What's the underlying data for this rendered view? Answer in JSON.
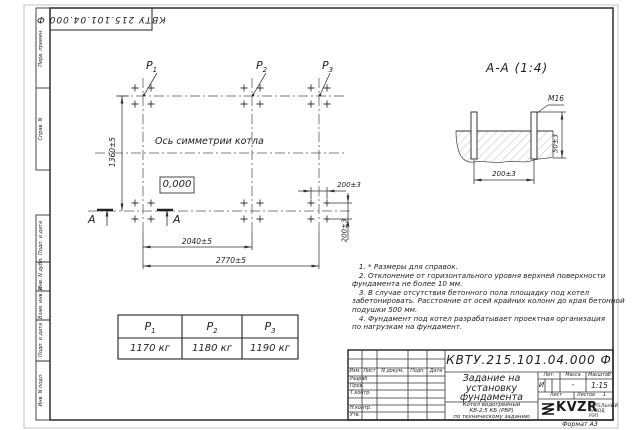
{
  "frame": {
    "stamp_code": "КВТУ 215.101.04.000 Ф",
    "top_margin_cells": [
      "Перв. примен.",
      "Справ. N"
    ],
    "side_margin_cells": [
      "Подп. и дата",
      "Инв. N дубл.",
      "Взам. инв. N",
      "Подп. и дата",
      "Инв. N подл."
    ],
    "format_label": "Формат А3"
  },
  "plan": {
    "loads": [
      {
        "sym": "P",
        "sub": "1"
      },
      {
        "sym": "P",
        "sub": "2"
      },
      {
        "sym": "P",
        "sub": "3"
      }
    ],
    "symmetry_axis_label": "Ось симметрии котла",
    "elevation_mark": "0,000",
    "section_letter": "А",
    "dim_height": "1360±5",
    "dim_span_inner": "2040±5",
    "dim_span_outer": "2770±5",
    "dim_bolt_x": "200±3",
    "dim_bolt_y": "200±3"
  },
  "section_view": {
    "title": "А-А (1:4)",
    "thread_label": "М16",
    "dim_width": "200±3",
    "dim_protrusion": "50±3"
  },
  "load_table": {
    "headers": [
      {
        "sym": "P",
        "sub": "1"
      },
      {
        "sym": "P",
        "sub": "2"
      },
      {
        "sym": "P",
        "sub": "3"
      }
    ],
    "values": [
      "1170 кг",
      "1180 кг",
      "1190 кг"
    ]
  },
  "notes": {
    "lines": [
      "   1. * Размеры для справок.",
      "   2. Отклонение от горизонтального уровня верхней поверхности",
      "фундамента не более 10 мм.",
      "   3. В случае отсутствия бетонного пола площадку под котел",
      "забетонировать. Расстояние от осей крайних колонн до края бетонной",
      "подушки 500 мм.",
      "   4. Фундамент под котел разрабатывает проектная организация",
      "по нагрузкам на фундамент."
    ]
  },
  "title_block": {
    "doc_number": "КВТУ.215.101.04.000 Ф",
    "title_lines": [
      "Задание на",
      "установку",
      "фундамента"
    ],
    "product_lines": [
      "Котел водогрейный",
      "КВ-2,5 КБ (РВР)",
      "по техническому заданию"
    ],
    "header_cols": [
      "Изм.",
      "Лист",
      "N докум.",
      "Подп.",
      "Дата"
    ],
    "row_labels": [
      "Разраб.",
      "Пров.",
      "Т.контр.",
      "Н.контр.",
      "Утв."
    ],
    "lit_header": "Лит.",
    "mass_header": "Масса",
    "scale_header": "Масштаб",
    "lit_value": "И",
    "mass_value": "-",
    "scale_value": "1:15",
    "sheet_label": "Лист",
    "sheets_label": "Листов",
    "sheets_value": "1",
    "logo_text": "KVZR",
    "company_lines": [
      "КОТЕЛЬНЫЙ",
      "ЗАВОД РЭП"
    ]
  }
}
